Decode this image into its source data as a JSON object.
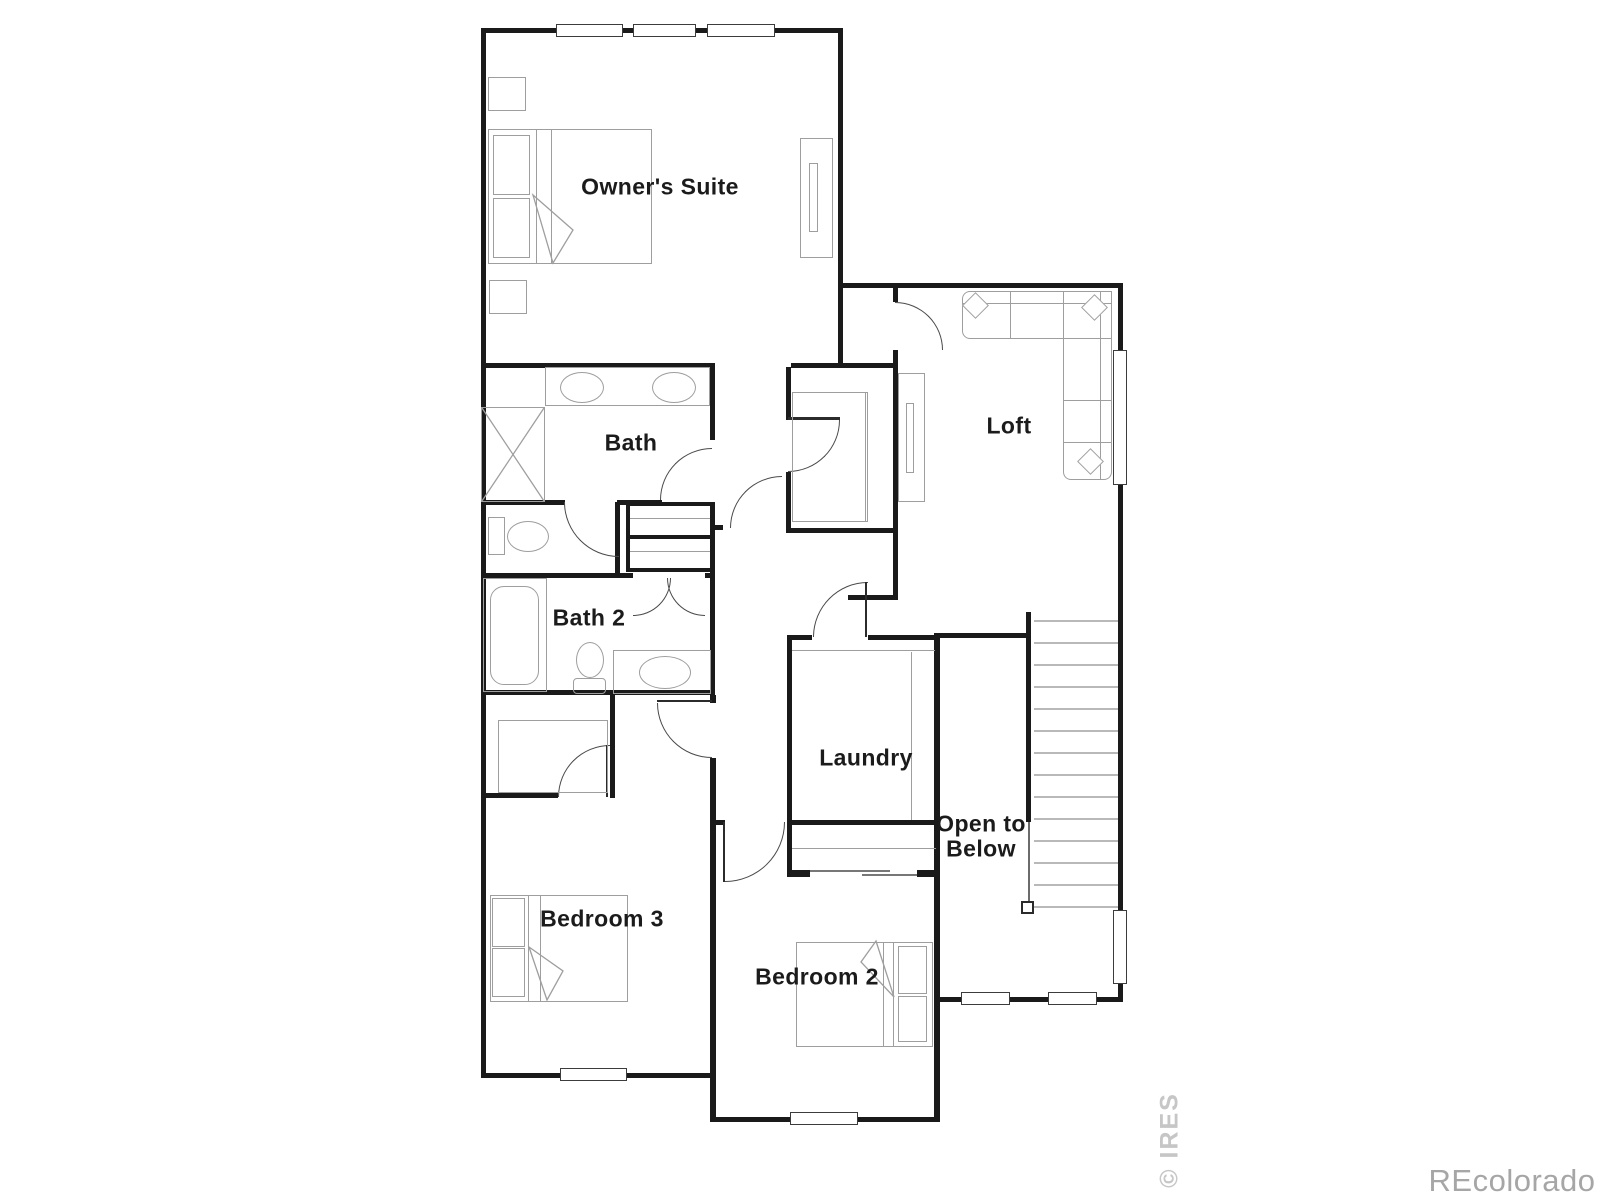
{
  "rooms": {
    "owners_suite": "Owner's Suite",
    "bath": "Bath",
    "bath2": "Bath 2",
    "loft": "Loft",
    "laundry": "Laundry",
    "open_below": "Open to Below",
    "bedroom3": "Bedroom 3",
    "bedroom2": "Bedroom 2"
  },
  "watermarks": {
    "ires": "© IRES",
    "brand": "REcolorado"
  },
  "colors": {
    "wall": "#1a1a1a",
    "furniture": "#9e9e9e",
    "label": "#1b1b1b",
    "watermark_ires": "#c6c6c6",
    "watermark_brand": "#a6a6a6"
  }
}
